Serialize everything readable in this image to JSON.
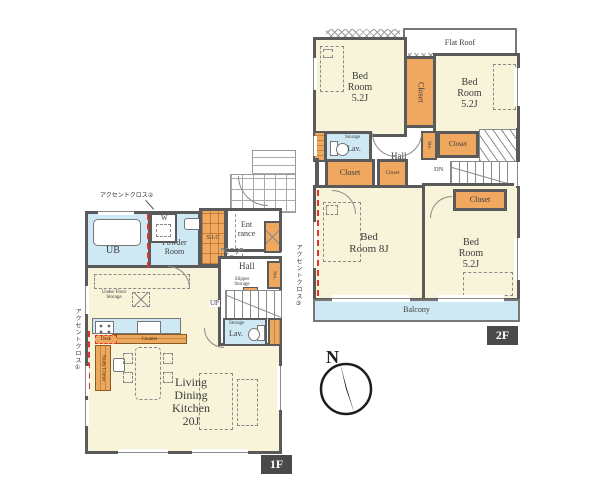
{
  "compass": {
    "label": "N"
  },
  "floor2": {
    "badge": "2F",
    "flat_roof": "Flat Roof",
    "bedroom_top_left": "Bed Room 5.2J",
    "bedroom_top_right": "Bed Room 5.2J",
    "bedroom_main": "Bed Room 8J",
    "bedroom_bottom_right": "Bed Room 5.2J",
    "closet_between": "Closet",
    "closet_hall_left": "Closet",
    "closet_hall_small": "Closet",
    "closet_hall_right": "Closet",
    "closet_bedroom": "Closet",
    "lav": "Lav.",
    "lav_storage": "Storage",
    "sto": "Sto.",
    "hall": "Hall",
    "down": "DN",
    "balcony": "Balcony",
    "accent_cloth": "アクセントクロス③"
  },
  "floor1": {
    "badge": "1F",
    "accent_cloth_top": "アクセントクロス②",
    "accent_cloth_left": "アクセントクロス①",
    "unit_bath": "UB",
    "washer": "W",
    "powder_room": "Powder Room",
    "shoe_closet": "S.I.C",
    "entrance": "Ent rance",
    "hall": "Hall",
    "slipper_storage": "Slipper Storage",
    "sto": "Sto.",
    "up": "UP",
    "refrigerator": "R",
    "lav": "Lav.",
    "lav_storage": "Storage",
    "under_floor_storage": "Under Floor Storage",
    "counter": "Counter",
    "desk": "Desk",
    "study_corner": "Study Corner",
    "ldk": [
      "Living",
      "Dining",
      "Kitchen",
      "20J"
    ]
  },
  "colors": {
    "room_floor": "#f8f4da",
    "wet_area": "#cfe9f4",
    "storage_orange": "#f0a75f",
    "wall": "#5a5a5a",
    "accent_red": "#e63329",
    "badge_bg": "#4a4a4a",
    "balcony": "#cfe9f4"
  },
  "icons": {
    "compass_needle": "black-needle-polygon",
    "bathtub": "rounded-rect",
    "toilet": "tank-and-bowl",
    "kitchen_sink": "rect",
    "stove": "four-dots",
    "bed": "dashed-rect",
    "door": "quarter-arc"
  }
}
